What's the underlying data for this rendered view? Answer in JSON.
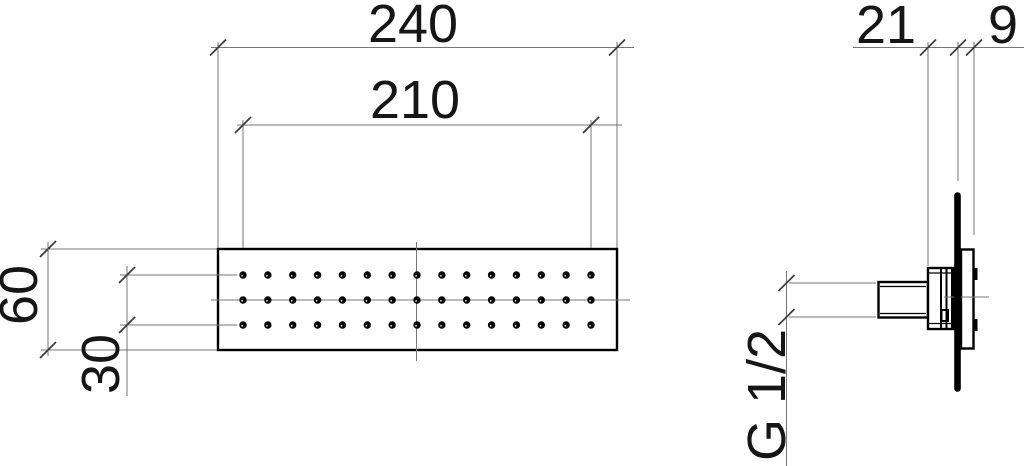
{
  "document": {
    "type": "technical dimension drawing",
    "background": "#ffffff"
  },
  "colors": {
    "background": "#ffffff",
    "object_line": "#000000",
    "thin_line": "#777777",
    "tick": "#3d3d3d",
    "text": "#161616"
  },
  "front_view": {
    "overall_width": "240",
    "nozzle_field_width": "210",
    "overall_height": "60",
    "nozzle_rows_span": "30",
    "nozzle_grid": {
      "rows": 3,
      "columns": 15
    }
  },
  "side_view": {
    "mounting_depth": "21",
    "plate_depth": "9",
    "thread": "G 1/2"
  }
}
